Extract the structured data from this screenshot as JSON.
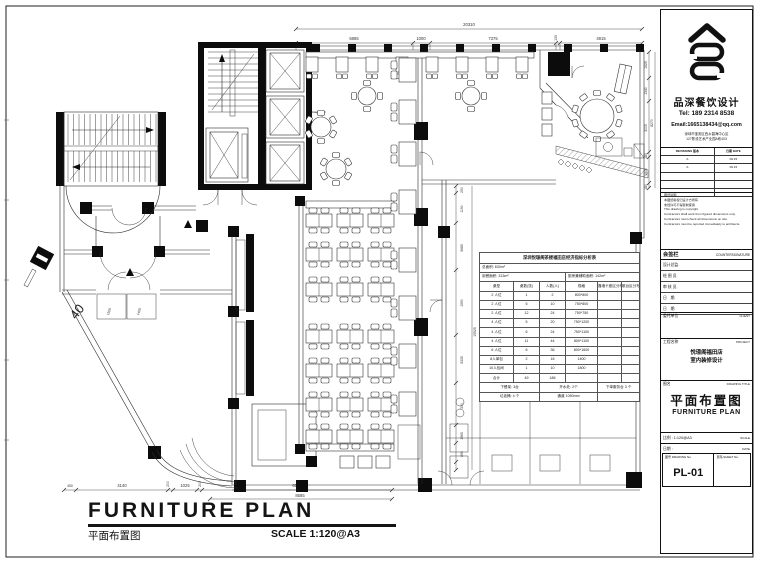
{
  "meta": {
    "ink": "#111111",
    "paper": "#ffffff",
    "dim_color": "#555555"
  },
  "title_block": {
    "company": "品深餐饮设计",
    "tel": "Tel: 189 2314 8538",
    "email": "Email:1665138434@qq.com",
    "address1": "深圳市宝安区西乡碧海中心区",
    "address2": "127陈设艺术产业园A栋403",
    "rev_head_l": "REVISIONS 版本",
    "rev_head_r": "日期 DATE",
    "rev_rows": [
      [
        "A",
        "09.15"
      ],
      [
        "A",
        "09.15"
      ],
      [
        "",
        ""
      ],
      [
        "",
        ""
      ],
      [
        "",
        ""
      ]
    ],
    "notes": [
      "图纸说明:",
      "本图纸版权归设计方所有",
      "未经许可不得复制使用",
      "This drawing is copyright.",
      "Contractors shall work from figured dimensions only.",
      "Contractors must check all dimensions on site.",
      "Contractors must be reported immediately to architects."
    ],
    "countersign_zh": "会签栏",
    "countersign_en": "COUNTERSIGNATURE",
    "sign_rows": [
      "设计总监.",
      "绘 图 员.",
      "审 核 员.",
      "日　期.",
      "日　期."
    ],
    "client_zh": "委托单位",
    "client_en": "CLIENT",
    "project_zh": "工程名称",
    "project_en": "PROJECT",
    "project_name1": "悦璟阁福田店",
    "project_name2": "室内装修设计",
    "dt_zh": "图名",
    "dt_en": "DRAWING TITLE",
    "dt_title_zh": "平面布置图",
    "dt_title_en": "FURNITURE PLAN",
    "scale_zh": "比例 : 1:120@A3",
    "scale_en": "SCALE",
    "date_zh": "日期 :",
    "date_en": "DATE",
    "dwgno_label": "图号 DRAWING No.",
    "dwgno_val": "PL-01",
    "sheet_label": "页码 SHEET No."
  },
  "footer": {
    "title_en": "FURNITURE PLAN",
    "title_zh": "平面布置图",
    "scale": "SCALE 1:120@A3"
  },
  "stats_table": {
    "title": "深圳悦璟阁茶楼福田店经济指标分析表",
    "total_area": "总面积: 630m²",
    "dining_area": "用餐面积: 313m²",
    "kitchen_area": "厨房兼辅助面积: 142m²",
    "headers": [
      "桌型",
      "桌数(张)",
      "人数(人)",
      "规格",
      "靠墙卡座区分布",
      "散台区分布"
    ],
    "rows": [
      [
        "2 人位",
        "1",
        "2",
        "800*800",
        "",
        ""
      ],
      [
        "2 人位",
        "5",
        "10",
        "750*800",
        "",
        ""
      ],
      [
        "2 人位",
        "12",
        "24",
        "750*750",
        "",
        ""
      ],
      [
        "4 人位",
        "5",
        "20",
        "750*1200",
        "",
        ""
      ],
      [
        "4 人位",
        "6",
        "24",
        "750*1100",
        "",
        ""
      ],
      [
        "4 人位",
        "11",
        "44",
        "800*1100",
        "",
        ""
      ],
      [
        "6 人位",
        "6",
        "36",
        "800*1600",
        "",
        ""
      ],
      [
        "8人单包",
        "2",
        "16",
        "1400",
        "",
        ""
      ],
      [
        "10人包间",
        "1",
        "10",
        "1800",
        "",
        ""
      ],
      [
        "合计",
        "49",
        "186",
        "",
        "",
        ""
      ]
    ],
    "footer_row1": [
      "下餐架: 3台",
      "开水处: 2个",
      "下单服务台 3 个"
    ],
    "footer_row2": [
      "垃圾桶: 4 个",
      "通道 1050mm",
      ""
    ]
  },
  "dims": {
    "top": {
      "total": "20310",
      "segments": [
        "6885",
        "1000",
        "7375",
        "135",
        "4915"
      ]
    },
    "right": {
      "total": "8270",
      "segments": [
        "1525",
        "1340",
        "3005",
        "180",
        "1500",
        "180"
      ]
    },
    "mid": {
      "total": "15925",
      "segments": [
        "250",
        "1190",
        "5685",
        "1590",
        "5335",
        "300",
        "1965",
        "890"
      ]
    },
    "bottom": {
      "total": "8585",
      "segments": [
        "450",
        "4140",
        "200",
        "1025",
        "200",
        "6500"
      ]
    }
  },
  "plan_labels": {
    "forty": "40",
    "door_a": "1500",
    "door_b": "1400"
  }
}
